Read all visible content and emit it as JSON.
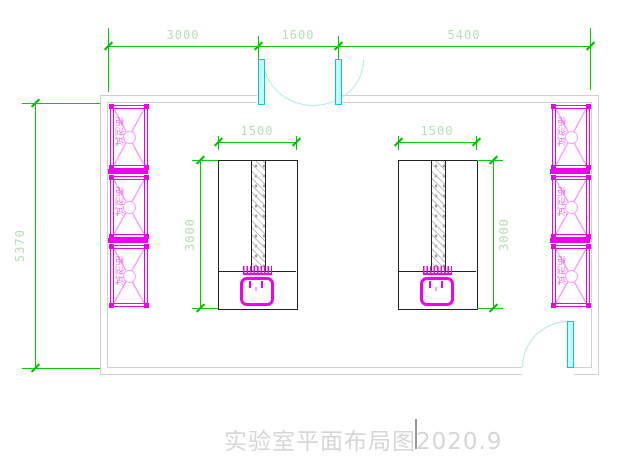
{
  "drawing_title": "实验室平面布局图2020.9",
  "dims": {
    "top": [
      "3000",
      "1600",
      "5400"
    ],
    "room_height": "5370",
    "bench_width": "1500",
    "bench_depth": "3000"
  },
  "cabinets": {
    "label": "试剂柜"
  },
  "colors": {
    "green": "#00cc00",
    "green_tick": "#00bb00",
    "dim_text": "#b8dcb8",
    "magenta": "#ee00ee",
    "pink": "#ff9bff",
    "label_pink": "#f060f0",
    "cyan": "#00cccc",
    "cyan_fill": "#c8f7f7",
    "cyan_arc": "#aee8e8",
    "wall": "#cfcfcf",
    "black": "#222222",
    "title": "#d6d6d6"
  }
}
